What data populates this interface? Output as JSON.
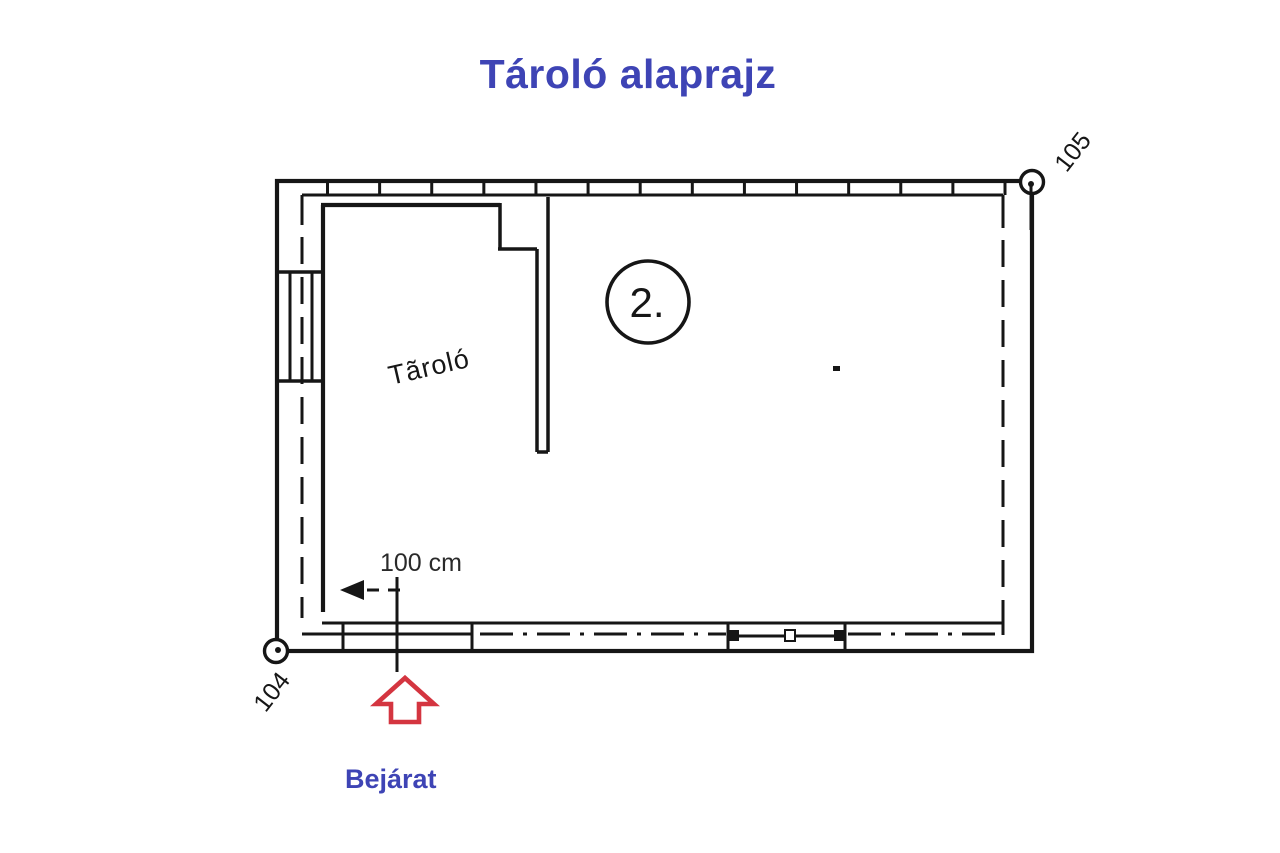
{
  "title": "Tároló alaprajz",
  "plan": {
    "room_label": "Tãroló",
    "unit_badge": "2.",
    "corner_marker_top_right": "105",
    "corner_marker_bottom_left": "104",
    "dimension_label": "100 cm",
    "entrance_label": "Bejárat"
  },
  "colors": {
    "title_blue": "#3e44b5",
    "entrance_arrow_red": "#d43540",
    "line_black": "#161616",
    "dim_text": "#2a2a2a"
  }
}
